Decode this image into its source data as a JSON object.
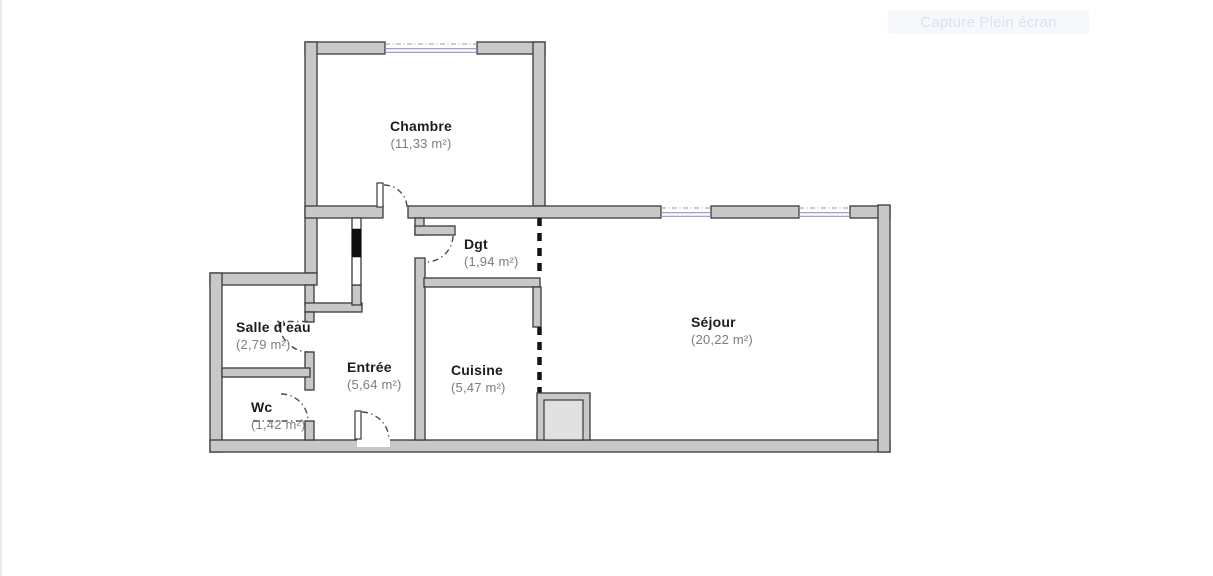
{
  "watermark": {
    "label": "Capture Plein écran"
  },
  "plan": {
    "rooms": [
      {
        "id": "chambre",
        "name": "Chambre",
        "area": "(11,33 m²)"
      },
      {
        "id": "dgt",
        "name": "Dgt",
        "area": "(1,94 m²)"
      },
      {
        "id": "salle-deau",
        "name": "Salle d'eau",
        "area": "(2,79 m²)"
      },
      {
        "id": "entree",
        "name": "Entrée",
        "area": "(5,64 m²)"
      },
      {
        "id": "cuisine",
        "name": "Cuisine",
        "area": "(5,47 m²)"
      },
      {
        "id": "wc",
        "name": "Wc",
        "area": "(1,42 m²)"
      },
      {
        "id": "sejour",
        "name": "Séjour",
        "area": "(20,22 m²)"
      }
    ],
    "colors": {
      "wall_fill": "#c8c8c8",
      "wall_edge": "#3a3a3a",
      "window_glass": "#8f94c4",
      "door_arc": "#4a4a4a",
      "partition_dash": "#141414",
      "shaft_fill": "#e0e0e0",
      "label_text": "#1d1d1d",
      "area_text": "#7d7d7d"
    }
  }
}
